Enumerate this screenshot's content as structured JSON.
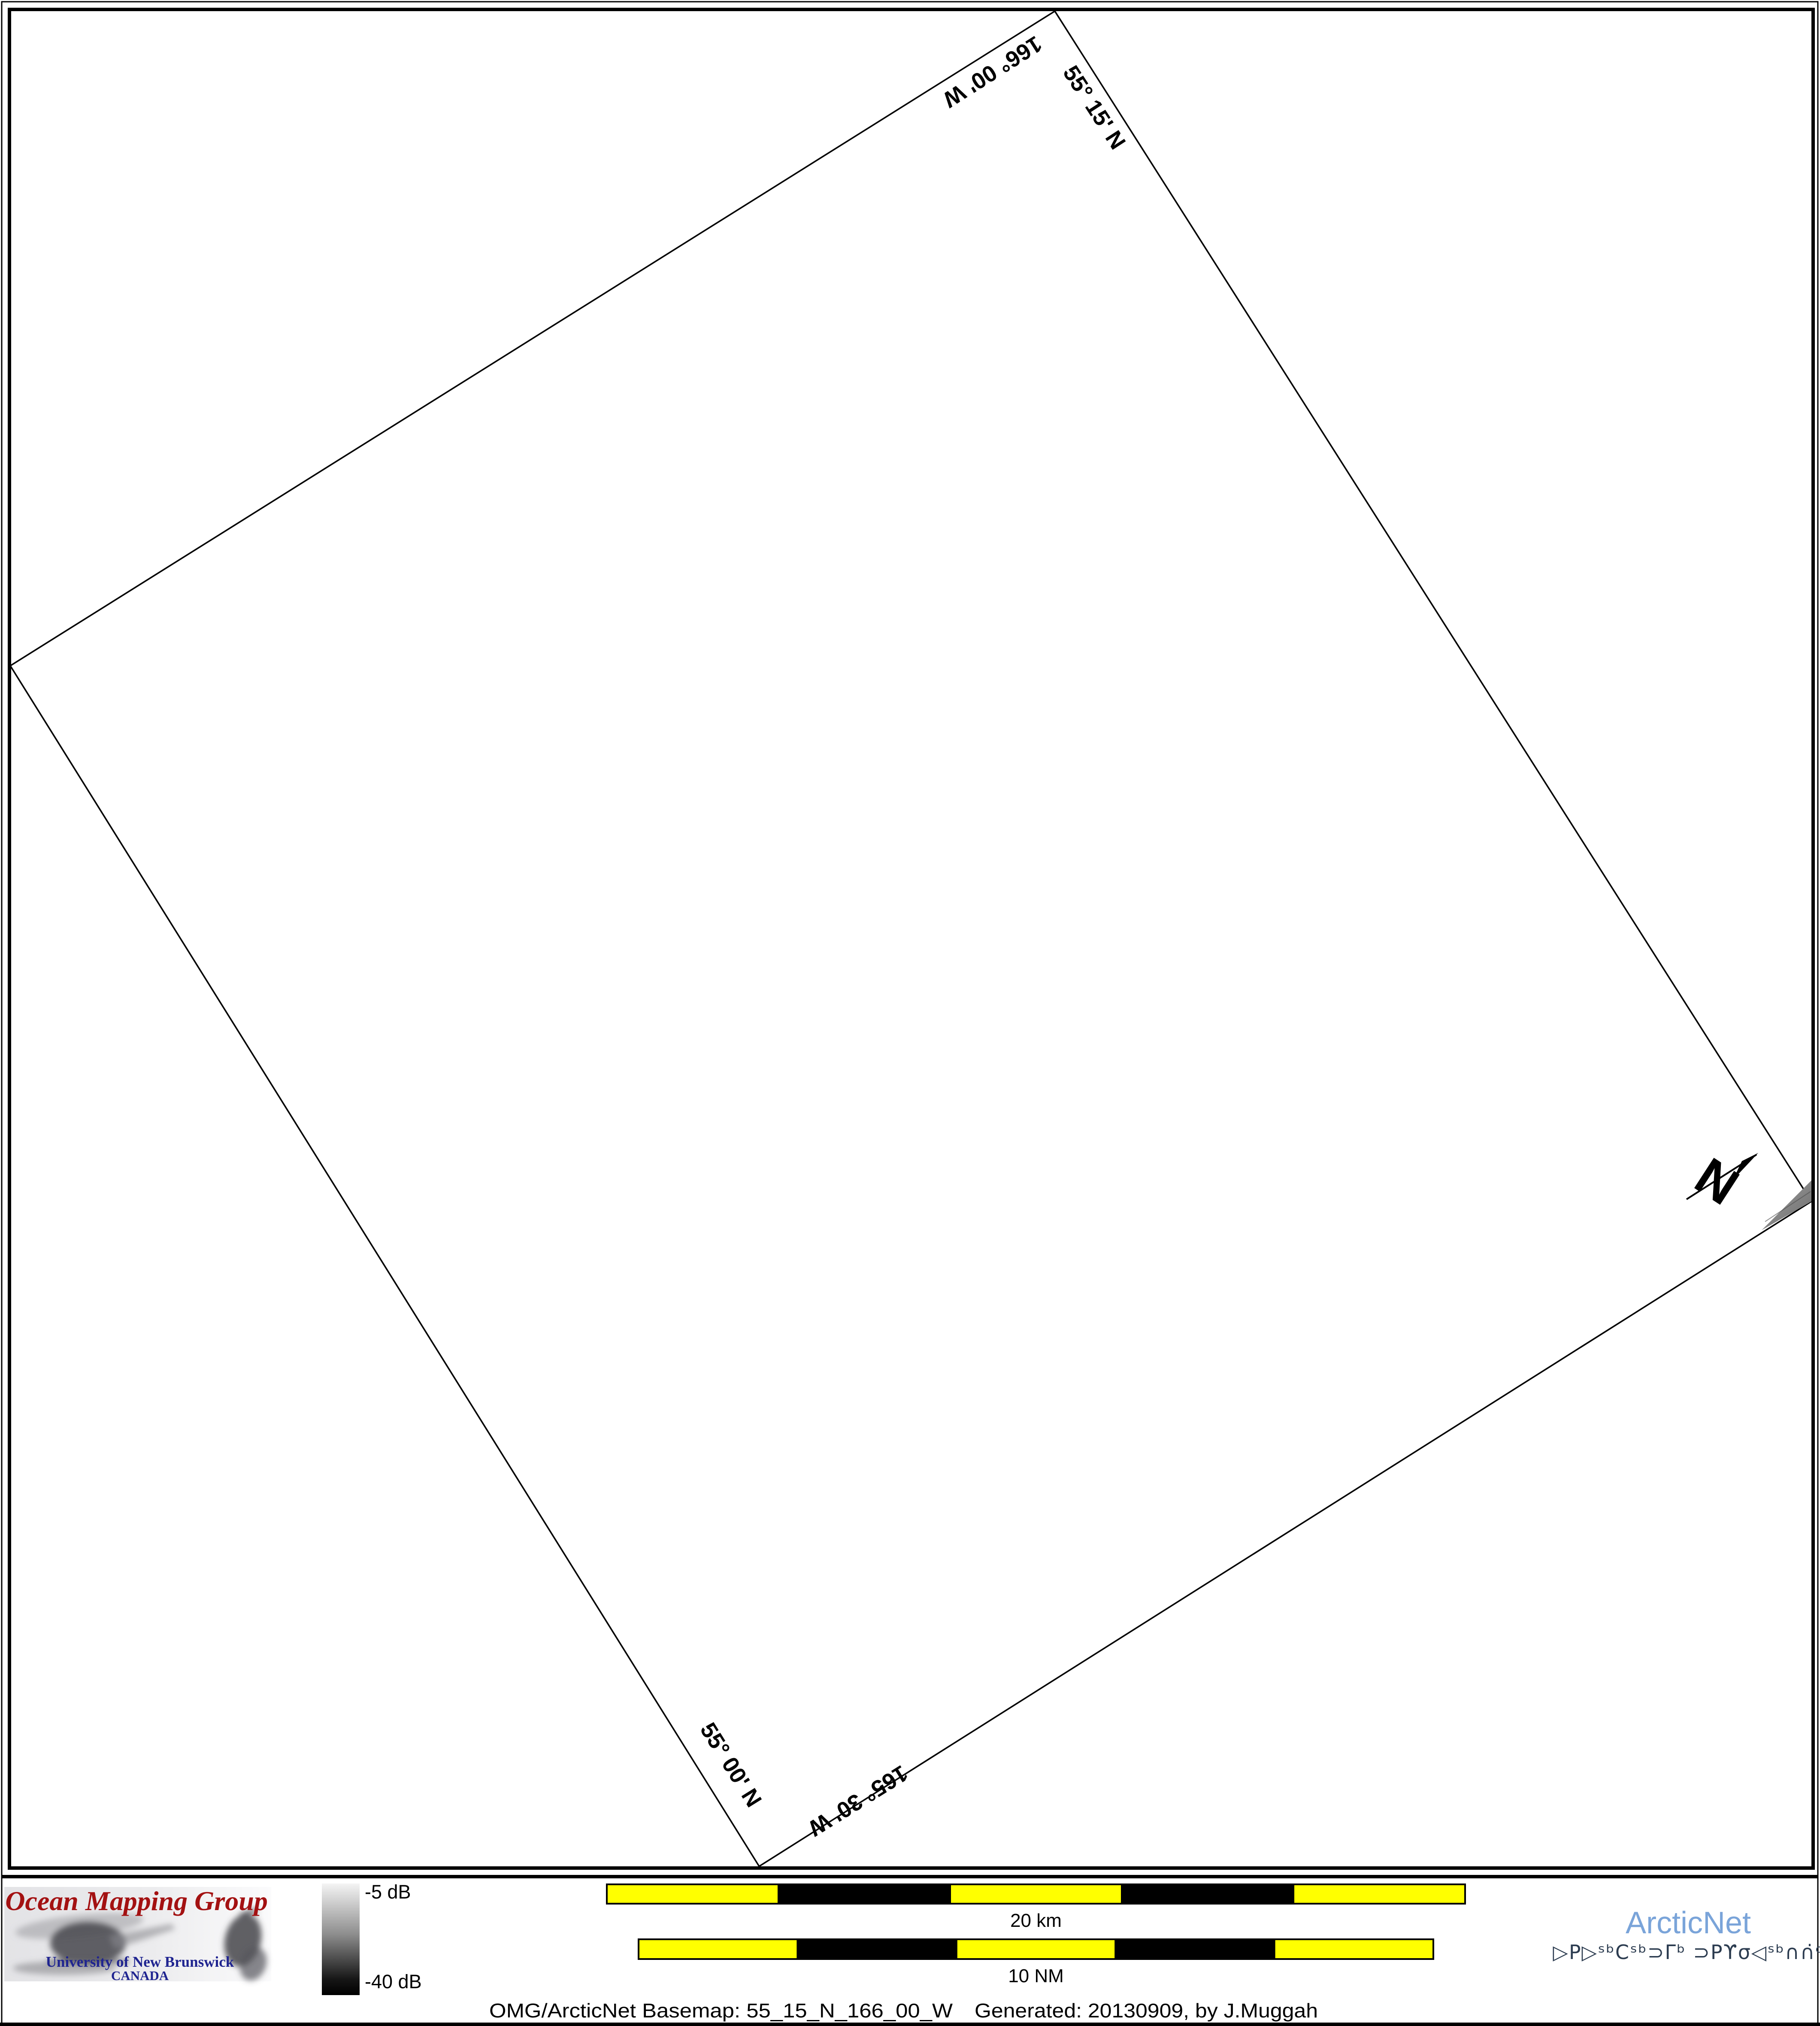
{
  "map_panel": {
    "edge_labels": {
      "top_left": "166° 00' W",
      "top_right": "55° 15' N",
      "bottom_left": "55° 00' N",
      "bottom_right": "165° 30' W"
    },
    "north_label": "N"
  },
  "colorbar": {
    "top_label": "-5 dB",
    "bottom_label": "-40 dB"
  },
  "scalebars": {
    "km": "20 km",
    "nm": "10 NM"
  },
  "logos": {
    "omg": {
      "title": "Ocean Mapping Group",
      "university": "University of New Brunswick",
      "country": "CANADA"
    },
    "arcticnet": {
      "name": "ArcticNet",
      "inuktitut": "▷P▷ˢᵇCˢᵇ⊃Γᵇ ⊃Pϒσ◁ˢᵇ∩∩̇ᶜ"
    }
  },
  "caption": {
    "basemap": "OMG/ArcticNet Basemap: 55_15_N_166_00_W",
    "generated": "Generated: 20130909, by J.Muggah"
  },
  "colors": {
    "scalebar_yellow": "#FFFF00",
    "omg_red": "#A31112",
    "unb_blue": "#1F2490",
    "arcticnet_blue": "#7AA4D9",
    "inuktitut_navy": "#2C3C50"
  }
}
